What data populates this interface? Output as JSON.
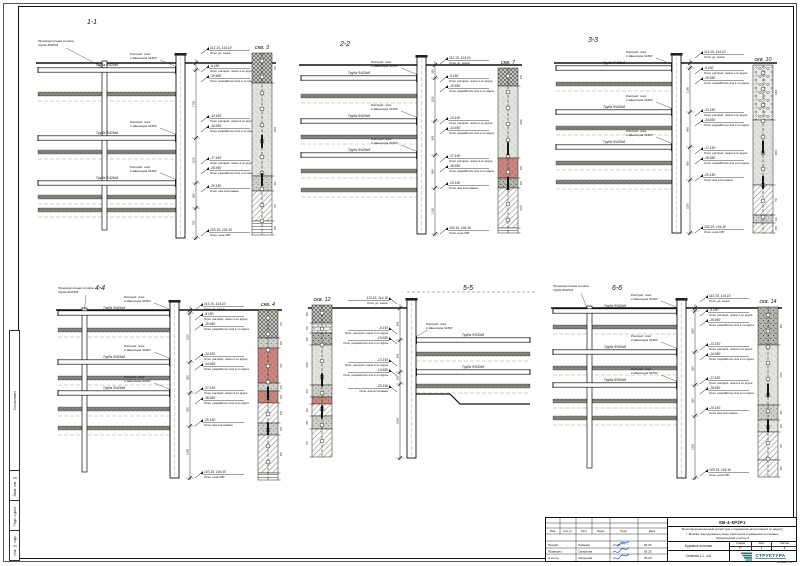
{
  "sheet": {
    "side_labels": [
      "Согласовано",
      "Взам. инв. №",
      "Подп. и дата",
      "Инв. № подл."
    ]
  },
  "titleblock": {
    "doc_code": "КВ-4-КР2Р1",
    "project_lines": [
      "Многофункциональный жилой дом с подземной автостоянкой по адресу:",
      "г. Москва, Аэродромная улица. Крепление ограждения котлована.",
      "Юридический участок 3"
    ],
    "drawing_title": "Буровые колонки",
    "sheet_caption": "Сечения 1-1...6-6",
    "stage_label": "Стадия",
    "list_label": "Лист",
    "lists_label": "Листов",
    "stage": "Р",
    "list": "1",
    "lists": "4",
    "org": "СТРУКТУРА",
    "format_note": "Формат А1",
    "sig_cols": [
      "Изм.",
      "Кол.уч.",
      "Лист",
      "№док.",
      "Подп.",
      "Дата"
    ],
    "rows": [
      [
        "Разраб.",
        "Лобанов",
        "05.25"
      ],
      [
        "Проверил",
        "Смирнова",
        "05.25"
      ],
      [
        "Н.контр.",
        "Смирнова",
        "05.25"
      ]
    ],
    "accent_color": "#0c5f5a"
  },
  "labels": {
    "belt1": "Распред. пояс",
    "belt2": "2 Швеллера №30У",
    "post1": "Промежуточная стойка",
    "post2": "Труба Ф325х8"
  },
  "ann_texts": [
    {
      "e": "113.15, 114.10",
      "t": "Отм. ур. земли"
    },
    {
      "e": "-9.150",
      "t": "Отм. распред. пояса 1-го яруса"
    },
    {
      "e": "-10.650",
      "t": "Отм. разработки для 1-го яруса"
    },
    {
      "e": "-13.150",
      "t": "Отм. распред. пояса 2-го яруса"
    },
    {
      "e": "-14.650",
      "t": "Отм. разработки для 2-го яруса"
    },
    {
      "e": "-17.150",
      "t": "Отм. распред. пояса 3-го яруса"
    },
    {
      "e": "-18.650",
      "t": "Отм. разработки для 3-го яруса"
    },
    {
      "e": "-20.150",
      "t": "Отм. дна котлована"
    },
    {
      "e": "103.15, 104.10",
      "t": "Отм. низа СВГ"
    }
  ],
  "sections": [
    {
      "id": "1-1",
      "x": 30,
      "y": 16,
      "w": 258,
      "h": 238,
      "tx": 62,
      "groundY": 47,
      "x0": 8,
      "wallX": 146,
      "wallW": 9,
      "wallBot": 222,
      "dimX": 166,
      "annX": 176,
      "struts": [
        54,
        122,
        167
      ],
      "soil": [
        76,
        134,
        179,
        192
      ],
      "pile": {
        "x": 72,
        "bot": 214
      },
      "ann": [
        [
          34,
          0
        ],
        [
          52,
          1
        ],
        [
          62,
          2
        ],
        [
          102,
          3
        ],
        [
          112,
          4
        ],
        [
          144,
          5
        ],
        [
          154,
          6
        ],
        [
          172,
          7
        ],
        [
          216,
          8
        ]
      ],
      "bh": {
        "x": 222,
        "w": 20,
        "top": 37,
        "label": "скв. 3",
        "layers": [
          [
            "cross",
            30
          ],
          [
            "stip",
            93
          ],
          [
            "gray",
            15
          ],
          [
            "diag",
            30
          ],
          [
            "hlines",
            14
          ]
        ]
      },
      "pipe": "Труба Ф426х8"
    },
    {
      "id": "2-2",
      "x": 295,
      "y": 38,
      "w": 235,
      "h": 212,
      "tx": 50,
      "groundY": 27,
      "x0": 6,
      "wallX": 122,
      "wallW": 9,
      "wallBot": 196,
      "dimX": 140,
      "annX": 150,
      "struts": [
        40,
        83,
        117
      ],
      "soil": [
        56,
        97,
        131,
        150
      ],
      "ann": [
        [
          22,
          0
        ],
        [
          40,
          1
        ],
        [
          50,
          2
        ],
        [
          82,
          3
        ],
        [
          92,
          4
        ],
        [
          120,
          5
        ],
        [
          130,
          6
        ],
        [
          147,
          7
        ],
        [
          192,
          8
        ]
      ],
      "bh": {
        "x": 203,
        "w": 20,
        "top": 30,
        "label": "скв. 7",
        "layers": [
          [
            "cross",
            18
          ],
          [
            "stip",
            72
          ],
          [
            "red",
            20
          ],
          [
            "speck",
            10
          ],
          [
            "diag",
            40
          ],
          [
            "hlines",
            5
          ]
        ]
      },
      "pipe": "Труба Ф426х8"
    },
    {
      "id": "3-3",
      "x": 550,
      "y": 34,
      "w": 245,
      "h": 212,
      "tx": 43,
      "groundY": 29,
      "x0": 6,
      "wallX": 122,
      "wallW": 9,
      "wallBot": 199,
      "dimX": 140,
      "annX": 150,
      "struts": [
        34,
        78,
        113
      ],
      "soil": [
        48,
        92,
        127,
        146
      ],
      "ann": [
        [
          20,
          0
        ],
        [
          36,
          1
        ],
        [
          46,
          2
        ],
        [
          78,
          3
        ],
        [
          88,
          4
        ],
        [
          116,
          5
        ],
        [
          126,
          6
        ],
        [
          143,
          7
        ],
        [
          195,
          8
        ]
      ],
      "bh": {
        "x": 203,
        "w": 20,
        "top": 31,
        "label": "скв. 10",
        "layers": [
          [
            "pebble",
            55
          ],
          [
            "stip",
            65
          ],
          [
            "diag",
            30
          ],
          [
            "gray",
            8
          ],
          [
            "diag",
            10
          ]
        ]
      },
      "pipe": "Труба Ф426х8"
    },
    {
      "id": "4-4",
      "x": 50,
      "y": 282,
      "w": 248,
      "h": 214,
      "tx": 50,
      "groundY": 28,
      "x0": 8,
      "wallX": 120,
      "wallW": 9,
      "wallBot": 196,
      "dimX": 140,
      "annX": 150,
      "struts": [
        31,
        80,
        111
      ],
      "soil": [
        46,
        94,
        125,
        144
      ],
      "pile": {
        "x": 32,
        "bot": 190
      },
      "ann": [
        [
          24,
          0
        ],
        [
          34,
          1
        ],
        [
          44,
          2
        ],
        [
          74,
          3
        ],
        [
          84,
          4
        ],
        [
          108,
          5
        ],
        [
          118,
          6
        ],
        [
          140,
          7
        ],
        [
          192,
          8
        ]
      ],
      "bh": {
        "x": 208,
        "w": 20,
        "top": 28,
        "label": "скв. 4",
        "layers": [
          [
            "cross",
            28
          ],
          [
            "gray",
            10
          ],
          [
            "red",
            35
          ],
          [
            "gray",
            8
          ],
          [
            "red",
            12
          ],
          [
            "diag",
            20
          ],
          [
            "gray",
            12
          ],
          [
            "diag",
            38
          ],
          [
            "hlines",
            7
          ]
        ]
      },
      "pipe": "Труба Ф426х8"
    },
    {
      "id": "5-5",
      "x": 300,
      "y": 282,
      "w": 240,
      "h": 208,
      "tx": 168,
      "orient": "left",
      "groundY": 26,
      "wallX": 107,
      "wallW": 9,
      "wallBot": 176,
      "dimX": 100,
      "annX": 92,
      "x1": 230,
      "struts": [
        58,
        90
      ],
      "soil": [
        70,
        102
      ],
      "step": {
        "y": 112,
        "xm": 150,
        "y2": 122
      },
      "ann": [
        [
          18,
          0
        ],
        [
          48,
          1
        ],
        [
          58,
          2
        ],
        [
          80,
          3
        ],
        [
          90,
          4
        ],
        [
          106,
          7
        ]
      ],
      "bh": {
        "x": 12,
        "w": 20,
        "top": 23,
        "label": "скв. 12",
        "layers": [
          [
            "cross",
            18
          ],
          [
            "brick",
            10
          ],
          [
            "speck",
            12
          ],
          [
            "stip",
            40
          ],
          [
            "gray",
            12
          ],
          [
            "red",
            7
          ],
          [
            "diag",
            12
          ],
          [
            "gray",
            13
          ],
          [
            "diag",
            28
          ]
        ]
      },
      "pipe": "Труба Ф530х8"
    },
    {
      "id": "6-6",
      "x": 545,
      "y": 282,
      "w": 250,
      "h": 212,
      "tx": 72,
      "groundY": 26,
      "x0": 8,
      "wallX": 132,
      "wallW": 9,
      "wallBot": 196,
      "dimX": 150,
      "annX": 160,
      "struts": [
        29,
        70,
        103
      ],
      "soil": [
        43,
        84,
        117,
        134
      ],
      "pile": {
        "x": 42,
        "bot": 186
      },
      "ann": [
        [
          16,
          0
        ],
        [
          30,
          1
        ],
        [
          40,
          2
        ],
        [
          64,
          3
        ],
        [
          74,
          4
        ],
        [
          98,
          5
        ],
        [
          108,
          6
        ],
        [
          128,
          7
        ],
        [
          190,
          8
        ]
      ],
      "bh": {
        "x": 213,
        "w": 20,
        "top": 25,
        "label": "скв. 14",
        "layers": [
          [
            "speck",
            38
          ],
          [
            "stip",
            60
          ],
          [
            "gray",
            15
          ],
          [
            "stip",
            12
          ],
          [
            "diag",
            28
          ],
          [
            "diag",
            17
          ]
        ]
      },
      "pipe": "Труба Ф530х8"
    }
  ]
}
